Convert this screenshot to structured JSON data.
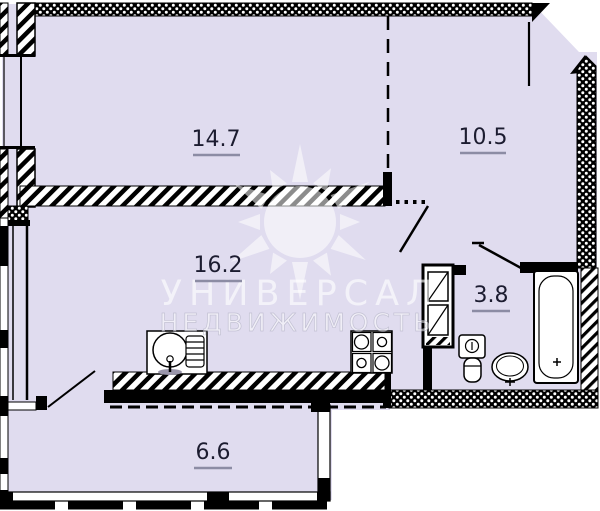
{
  "plan": {
    "rooms": [
      {
        "area": "14.7"
      },
      {
        "area": "10.5"
      },
      {
        "area": "16.2"
      },
      {
        "area": "3.8"
      },
      {
        "area": "6.6"
      }
    ],
    "watermark": {
      "line1": "УНИВЕРСАЛ",
      "line2": "НЕДВИЖИМОСТЬ",
      "logo": "sun-logo"
    },
    "fixtures": [
      "kitchen-sink",
      "stove",
      "ventilation-shaft",
      "toilet",
      "washbasin",
      "bathtub"
    ],
    "colors": {
      "floor": "#e0dcef",
      "wall": "#000000",
      "label": "#1c1c30",
      "underline": "#8c8ca4",
      "watermark": "#ffffff"
    }
  }
}
